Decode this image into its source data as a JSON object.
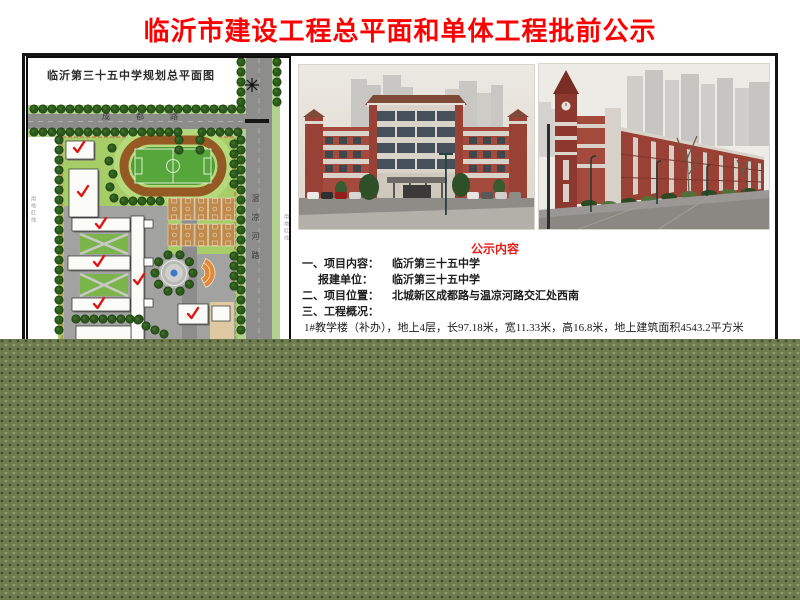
{
  "title": "临沂市建设工程总平面和单体工程批前公示",
  "colors": {
    "title_red": "#fd0100",
    "heading_red": "#e51b15",
    "overlay_olive": "#6e7c50",
    "plan_green": "#a6cd68",
    "track_brown": "#955a24",
    "field_green": "#57a63c",
    "road_gray": "#8d8d8b",
    "checkmark_red": "#e11414",
    "school_brick_red": "#9a4136"
  },
  "plan": {
    "title": "临沂第三十五中学规划总平面图",
    "road_horizontal": "成都路",
    "road_vertical": "温凉河路",
    "annotation_left": "用地红线",
    "annotation_right": "用地红线"
  },
  "notice": {
    "heading": "公示内容",
    "lines": [
      {
        "label": "一、项目内容：",
        "value": "临沂第三十五中学"
      },
      {
        "label": "报建单位：",
        "value": "临沂第三十五中学"
      },
      {
        "label": "二、项目位置：",
        "value": "北城新区成都路与温凉河路交汇处西南"
      },
      {
        "label": "三、工程概况：",
        "value": ""
      },
      {
        "label": "",
        "value": "1#教学楼（补办），地上4层，长97.18米，宽11.33米，高16.8米，地上建筑面积4543.2平方米"
      }
    ]
  }
}
